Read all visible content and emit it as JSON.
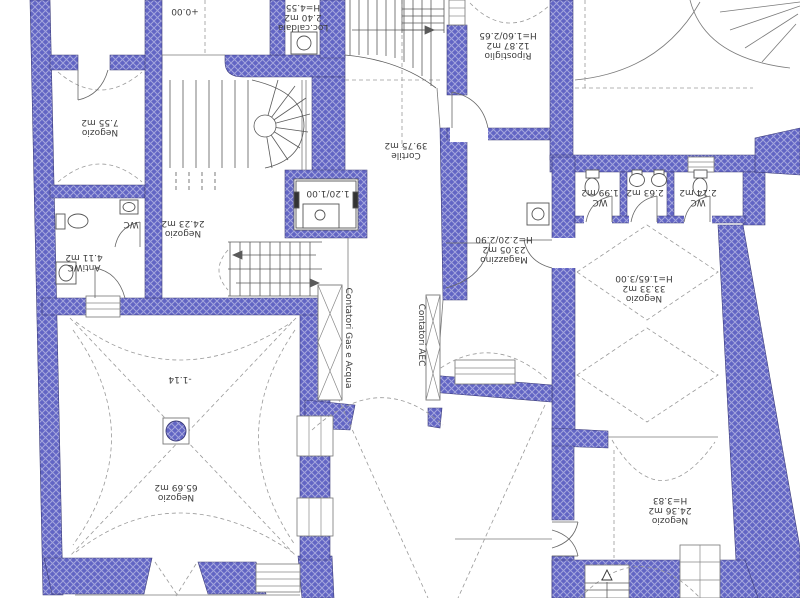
{
  "drawing": {
    "colors": {
      "wall_fill": "#6265c4",
      "wall_hatch": "#ffffff",
      "wall_edge": "#3b3b77",
      "line": "#6a6a6a",
      "dashed_line": "#9a9a9a",
      "text": "#3d3d3d"
    },
    "labels": {
      "level_entry": {
        "value": "+0.00"
      },
      "negozio_755": {
        "name": "Negozio",
        "area": "7.55 m2"
      },
      "wc_left": {
        "name": "WC"
      },
      "antiwc": {
        "name": "AntiWC",
        "area": "4.11 m2"
      },
      "negozio_2423": {
        "name": "Negozio",
        "area": "24.23 m2"
      },
      "loc_caldaia": {
        "name": "Loc.caldaia",
        "area": "2.40 m2",
        "height": "H=4.55"
      },
      "elevator": {
        "value": "1.20/1.00"
      },
      "cortile": {
        "name": "Cortile",
        "area": "39.75 m2"
      },
      "ripostiglio": {
        "name": "Ripostiglio",
        "area": "12.87 m2",
        "height": "H=1.60/2.65"
      },
      "magazzino": {
        "name": "Magazzino",
        "area": "23.05 m2",
        "height": "H=2.20/2.90"
      },
      "wc_1": {
        "name": "WC",
        "area": "1.99 m2"
      },
      "bagno": {
        "area": "2.63 m2"
      },
      "wc_2": {
        "name": "WC",
        "area": "2.14 m2"
      },
      "negozio_3333": {
        "name": "Negozio",
        "area": "33.33 m2",
        "height": "H=1.65/3.00"
      },
      "level_lower": {
        "value": "-1.14"
      },
      "negozio_6569": {
        "name": "Negozio",
        "area": "65.69 m2"
      },
      "negozio_2436": {
        "name": "Negozio",
        "area": "24.36 m2",
        "height": "H=3.83"
      },
      "contatori_gas": {
        "value": "Contatori Gas e Acqua"
      },
      "contatori_aec": {
        "value": "Contatori AEC"
      }
    }
  }
}
